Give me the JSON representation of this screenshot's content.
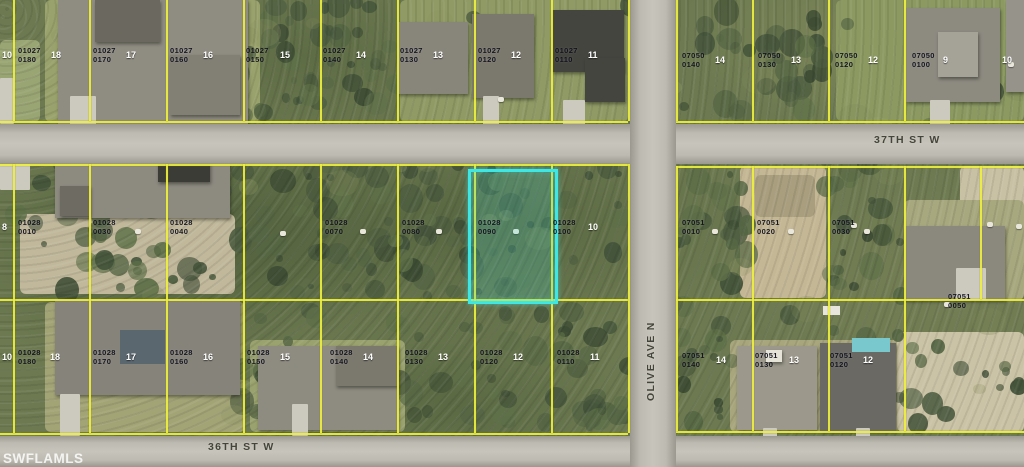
{
  "map": {
    "watermark": "SWFLAMLS",
    "colors": {
      "boundary": "#eef03c",
      "highlight": "#3ce8e6",
      "road": "#bdbbb1",
      "vegetation": "#6d7a51",
      "parcel_text": "#10101c",
      "lot_text": "#ffffff",
      "street_text": "#45443c"
    },
    "highlight": {
      "parcel": "01028 0090",
      "x": 468,
      "y": 169,
      "w": 84,
      "h": 129
    },
    "streets": [
      {
        "label": "37TH ST W",
        "x": 874,
        "y": 134,
        "vertical": false
      },
      {
        "label": "36TH ST W",
        "x": 208,
        "y": 441,
        "vertical": false
      },
      {
        "label": "OLIVE AVE N",
        "x": 645,
        "y": 401,
        "vertical": true
      }
    ],
    "parcel_labels": [
      {
        "block": "01027",
        "lot": "0180",
        "x": 18,
        "y": 47
      },
      {
        "block": "01027",
        "lot": "0170",
        "x": 93,
        "y": 47
      },
      {
        "block": "01027",
        "lot": "0160",
        "x": 170,
        "y": 47
      },
      {
        "block": "01027",
        "lot": "0150",
        "x": 246,
        "y": 47
      },
      {
        "block": "01027",
        "lot": "0140",
        "x": 323,
        "y": 47
      },
      {
        "block": "01027",
        "lot": "0130",
        "x": 400,
        "y": 47
      },
      {
        "block": "01027",
        "lot": "0120",
        "x": 478,
        "y": 47
      },
      {
        "block": "01027",
        "lot": "0110",
        "x": 555,
        "y": 47
      },
      {
        "block": "07050",
        "lot": "0140",
        "x": 682,
        "y": 52
      },
      {
        "block": "07050",
        "lot": "0130",
        "x": 758,
        "y": 52
      },
      {
        "block": "07050",
        "lot": "0120",
        "x": 835,
        "y": 52
      },
      {
        "block": "07050",
        "lot": "0100",
        "x": 912,
        "y": 52
      },
      {
        "block": "01028",
        "lot": "0010",
        "x": 18,
        "y": 219
      },
      {
        "block": "01028",
        "lot": "0030",
        "x": 93,
        "y": 219
      },
      {
        "block": "01028",
        "lot": "0040",
        "x": 170,
        "y": 219
      },
      {
        "block": "01028",
        "lot": "0070",
        "x": 325,
        "y": 219
      },
      {
        "block": "01028",
        "lot": "0080",
        "x": 402,
        "y": 219
      },
      {
        "block": "01028",
        "lot": "0090",
        "x": 478,
        "y": 219,
        "highlighted": true
      },
      {
        "block": "01028",
        "lot": "0100",
        "x": 553,
        "y": 219
      },
      {
        "block": "07051",
        "lot": "0010",
        "x": 682,
        "y": 219
      },
      {
        "block": "07051",
        "lot": "0020",
        "x": 757,
        "y": 219
      },
      {
        "block": "07051",
        "lot": "0030",
        "x": 832,
        "y": 219
      },
      {
        "block": "07051",
        "lot": "0050",
        "x": 948,
        "y": 293
      },
      {
        "block": "01028",
        "lot": "0180",
        "x": 18,
        "y": 349
      },
      {
        "block": "01028",
        "lot": "0170",
        "x": 93,
        "y": 349
      },
      {
        "block": "01028",
        "lot": "0160",
        "x": 170,
        "y": 349
      },
      {
        "block": "01028",
        "lot": "0150",
        "x": 247,
        "y": 349
      },
      {
        "block": "01028",
        "lot": "0140",
        "x": 330,
        "y": 349
      },
      {
        "block": "01028",
        "lot": "0130",
        "x": 405,
        "y": 349
      },
      {
        "block": "01028",
        "lot": "0120",
        "x": 480,
        "y": 349
      },
      {
        "block": "01028",
        "lot": "0110",
        "x": 557,
        "y": 349
      },
      {
        "block": "07051",
        "lot": "0140",
        "x": 682,
        "y": 352
      },
      {
        "block": "07051",
        "lot": "0130",
        "x": 755,
        "y": 352
      },
      {
        "block": "07051",
        "lot": "0120",
        "x": 830,
        "y": 352
      }
    ],
    "lot_numbers": [
      {
        "t": "10",
        "x": 2,
        "y": 50
      },
      {
        "t": "18",
        "x": 51,
        "y": 50
      },
      {
        "t": "17",
        "x": 126,
        "y": 50
      },
      {
        "t": "16",
        "x": 203,
        "y": 50
      },
      {
        "t": "15",
        "x": 280,
        "y": 50
      },
      {
        "t": "14",
        "x": 356,
        "y": 50
      },
      {
        "t": "13",
        "x": 433,
        "y": 50
      },
      {
        "t": "12",
        "x": 511,
        "y": 50
      },
      {
        "t": "11",
        "x": 588,
        "y": 50
      },
      {
        "t": "14",
        "x": 715,
        "y": 55
      },
      {
        "t": "13",
        "x": 791,
        "y": 55
      },
      {
        "t": "12",
        "x": 868,
        "y": 55
      },
      {
        "t": "9",
        "x": 943,
        "y": 55
      },
      {
        "t": "10",
        "x": 1002,
        "y": 55
      },
      {
        "t": "8",
        "x": 2,
        "y": 222
      },
      {
        "t": "10",
        "x": 588,
        "y": 222
      },
      {
        "t": "10",
        "x": 2,
        "y": 352
      },
      {
        "t": "18",
        "x": 50,
        "y": 352
      },
      {
        "t": "17",
        "x": 126,
        "y": 352
      },
      {
        "t": "16",
        "x": 203,
        "y": 352
      },
      {
        "t": "15",
        "x": 280,
        "y": 352
      },
      {
        "t": "14",
        "x": 363,
        "y": 352
      },
      {
        "t": "13",
        "x": 438,
        "y": 352
      },
      {
        "t": "12",
        "x": 513,
        "y": 352
      },
      {
        "t": "11",
        "x": 590,
        "y": 352
      },
      {
        "t": "14",
        "x": 716,
        "y": 355
      },
      {
        "t": "13",
        "x": 789,
        "y": 355
      },
      {
        "t": "12",
        "x": 863,
        "y": 355
      }
    ]
  }
}
